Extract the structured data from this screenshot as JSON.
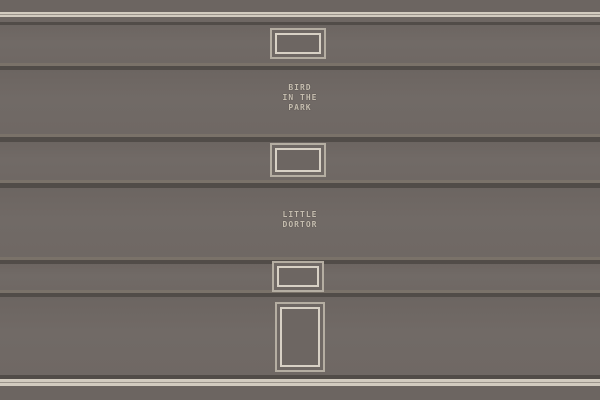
{
  "wall": {
    "signs": [
      {
        "id": "bird-in-the-park",
        "lines": [
          "BIRD",
          "IN THE",
          "PARK"
        ]
      },
      {
        "id": "little-dortor",
        "lines": [
          "LITTLE",
          "DORTOR"
        ]
      }
    ]
  },
  "colors": {
    "band": "#6f6864",
    "band_top_bottom": "#6c6561",
    "band_upper": "#6e6763",
    "stripe_light": "#d2cbbf",
    "stripe_mid": "#9b948b",
    "groove_dark": "#514c48",
    "groove_highlight": "#7a7269",
    "frame_outer": "#b5aea2",
    "frame_inner": "#d8d1c5",
    "sign_text": "#c6beb0"
  }
}
